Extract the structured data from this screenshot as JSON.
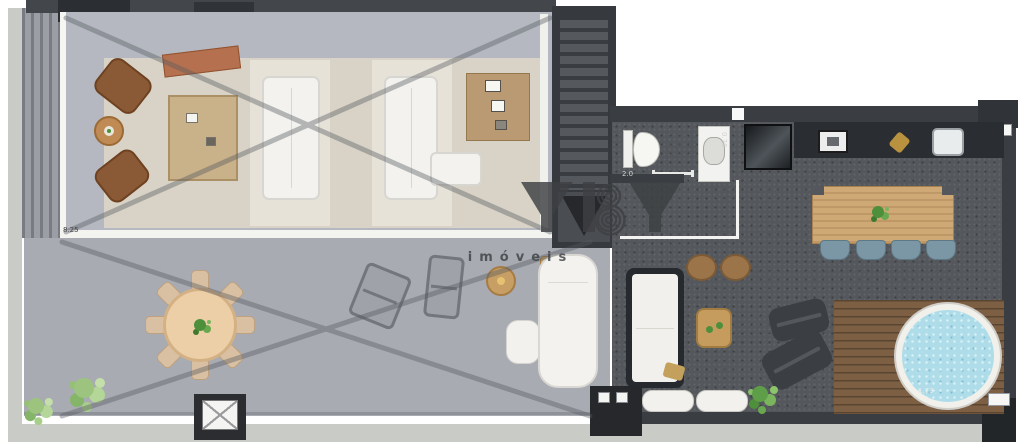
{
  "watermark": {
    "logo": "YBY",
    "subtitle": "imóveis"
  },
  "dim_labels": {
    "living": "8.25",
    "wc": "2.0",
    "basin": "0.70",
    "deck": "1.73"
  },
  "palette": {
    "wall": "#3a3d41",
    "room_floor": "#b5b8c0",
    "terrace_floor": "#a8abb2",
    "carpet": "#54575c",
    "rug": "#d8d3c6",
    "wood": "#c9a36b",
    "deck_wood": "#7d5f44",
    "hot_tub_water": "#aedce9",
    "dining_chair_blue": "#7b97a5",
    "plant_green": "#6aa84f",
    "white_furniture": "#f2f1ed",
    "accent_terracotta": "#b5714f"
  },
  "icons": {
    "stairs_direction_arrow": "triangle-down",
    "skylight_cross": "x-panel"
  }
}
